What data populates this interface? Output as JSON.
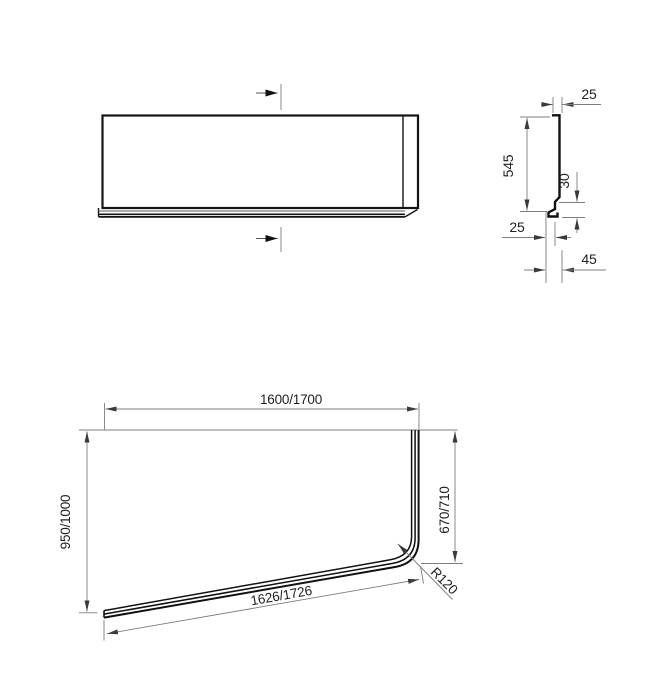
{
  "colors": {
    "outline": "#1a1a1a",
    "dimension_line": "#7d7d7d",
    "text": "#222222",
    "background": "#ffffff"
  },
  "dimensions": {
    "profile": {
      "top_width": "25",
      "height": "545",
      "foot_height": "30",
      "foot_offset": "25",
      "foot_depth": "45"
    },
    "plan": {
      "length": "1600/1700",
      "width": "950/1000",
      "side": "670/710",
      "panel_length": "1626/1726",
      "corner_radius": "R120"
    }
  }
}
